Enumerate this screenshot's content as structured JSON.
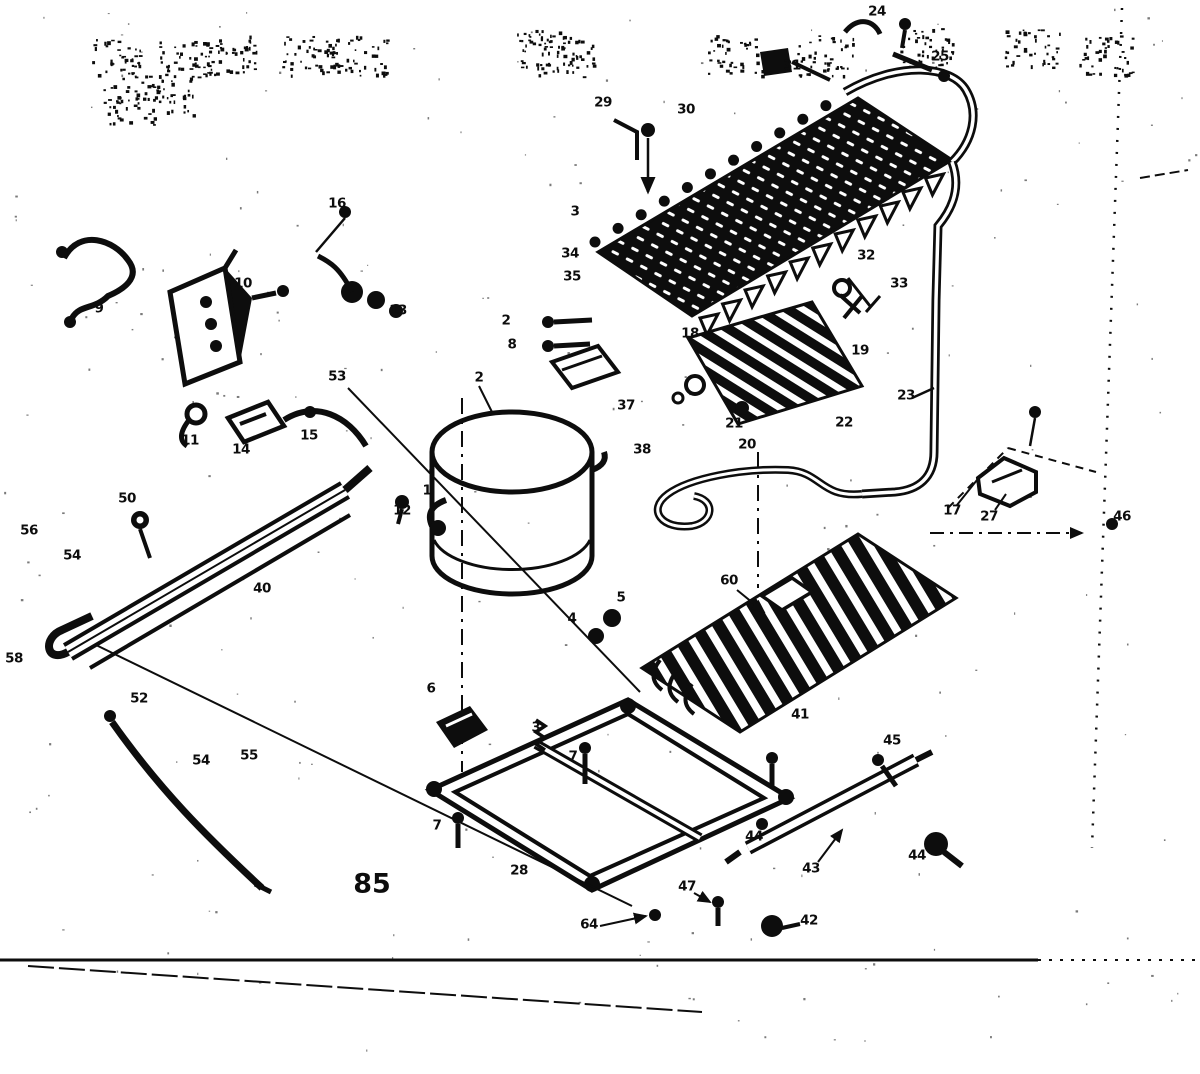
{
  "figure": {
    "type": "exploded-parts-diagram",
    "caption_label": "85",
    "caption_x": 372,
    "caption_y": 884,
    "ink_color": "#0d0d0d",
    "paper_color": "#ffffff"
  },
  "callouts": [
    {
      "n": "24",
      "x": 877,
      "y": 12
    },
    {
      "n": "25",
      "x": 940,
      "y": 57
    },
    {
      "n": "31",
      "x": 792,
      "y": 66
    },
    {
      "n": "29",
      "x": 603,
      "y": 103
    },
    {
      "n": "30",
      "x": 686,
      "y": 110
    },
    {
      "n": "16",
      "x": 337,
      "y": 204
    },
    {
      "n": "3",
      "x": 575,
      "y": 212
    },
    {
      "n": "34",
      "x": 570,
      "y": 254
    },
    {
      "n": "35",
      "x": 572,
      "y": 277
    },
    {
      "n": "32",
      "x": 866,
      "y": 256
    },
    {
      "n": "33",
      "x": 899,
      "y": 284
    },
    {
      "n": "9",
      "x": 99,
      "y": 309
    },
    {
      "n": "10",
      "x": 243,
      "y": 284
    },
    {
      "n": "13",
      "x": 398,
      "y": 311
    },
    {
      "n": "2",
      "x": 506,
      "y": 321
    },
    {
      "n": "8",
      "x": 512,
      "y": 345
    },
    {
      "n": "18",
      "x": 690,
      "y": 334
    },
    {
      "n": "19",
      "x": 860,
      "y": 351
    },
    {
      "n": "2",
      "x": 479,
      "y": 378
    },
    {
      "n": "53",
      "x": 337,
      "y": 377
    },
    {
      "n": "11",
      "x": 190,
      "y": 441
    },
    {
      "n": "14",
      "x": 241,
      "y": 450
    },
    {
      "n": "15",
      "x": 309,
      "y": 436
    },
    {
      "n": "12",
      "x": 402,
      "y": 511
    },
    {
      "n": "37",
      "x": 626,
      "y": 406
    },
    {
      "n": "38",
      "x": 642,
      "y": 450
    },
    {
      "n": "21",
      "x": 734,
      "y": 424
    },
    {
      "n": "20",
      "x": 747,
      "y": 445
    },
    {
      "n": "22",
      "x": 844,
      "y": 423
    },
    {
      "n": "23",
      "x": 906,
      "y": 396
    },
    {
      "n": "17",
      "x": 952,
      "y": 511
    },
    {
      "n": "27",
      "x": 989,
      "y": 517
    },
    {
      "n": "46",
      "x": 1122,
      "y": 517
    },
    {
      "n": "1",
      "x": 427,
      "y": 491
    },
    {
      "n": "50",
      "x": 127,
      "y": 499
    },
    {
      "n": "56",
      "x": 29,
      "y": 531
    },
    {
      "n": "54",
      "x": 72,
      "y": 556
    },
    {
      "n": "40",
      "x": 262,
      "y": 589
    },
    {
      "n": "58",
      "x": 14,
      "y": 659
    },
    {
      "n": "52",
      "x": 139,
      "y": 699
    },
    {
      "n": "54",
      "x": 201,
      "y": 761
    },
    {
      "n": "55",
      "x": 249,
      "y": 756
    },
    {
      "n": "5",
      "x": 621,
      "y": 598
    },
    {
      "n": "4",
      "x": 572,
      "y": 619
    },
    {
      "n": "60",
      "x": 729,
      "y": 581
    },
    {
      "n": "6",
      "x": 431,
      "y": 689
    },
    {
      "n": "3",
      "x": 536,
      "y": 728
    },
    {
      "n": "7",
      "x": 573,
      "y": 757
    },
    {
      "n": "41",
      "x": 800,
      "y": 715
    },
    {
      "n": "45",
      "x": 892,
      "y": 741
    },
    {
      "n": "44",
      "x": 754,
      "y": 837
    },
    {
      "n": "44",
      "x": 917,
      "y": 856
    },
    {
      "n": "43",
      "x": 811,
      "y": 869
    },
    {
      "n": "7",
      "x": 437,
      "y": 826
    },
    {
      "n": "28",
      "x": 519,
      "y": 871
    },
    {
      "n": "64",
      "x": 589,
      "y": 925
    },
    {
      "n": "47",
      "x": 687,
      "y": 887
    },
    {
      "n": "42",
      "x": 809,
      "y": 921
    }
  ]
}
